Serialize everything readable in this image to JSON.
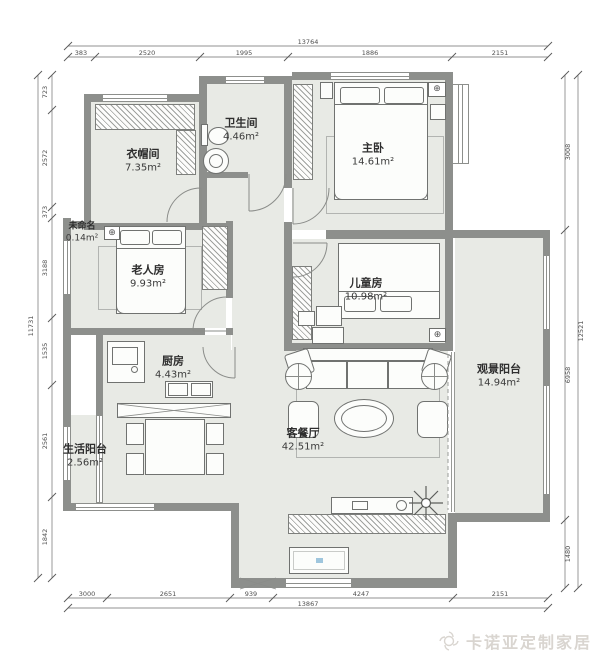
{
  "watermark": {
    "text": "卡诺亚定制家居"
  },
  "rooms": [
    {
      "id": "cloakroom",
      "name": "衣帽间",
      "area": "7.35m²"
    },
    {
      "id": "bathroom",
      "name": "卫生间",
      "area": "4.46m²"
    },
    {
      "id": "master",
      "name": "主卧",
      "area": "14.61m²"
    },
    {
      "id": "unnamed",
      "name": "未命名",
      "area": "0.14m²"
    },
    {
      "id": "elder-room",
      "name": "老人房",
      "area": "9.93m²"
    },
    {
      "id": "kids-room",
      "name": "儿童房",
      "area": "10.98m²"
    },
    {
      "id": "kitchen",
      "name": "厨房",
      "area": "4.43m²"
    },
    {
      "id": "living-dining",
      "name": "客餐厅",
      "area": "42.51m²"
    },
    {
      "id": "view-balcony",
      "name": "观景阳台",
      "area": "14.94m²"
    },
    {
      "id": "life-balcony",
      "name": "生活阳台",
      "area": "2.56m²"
    }
  ],
  "dimensions": {
    "top": {
      "total": "13764",
      "segments": [
        "383",
        "2520",
        "1995",
        "1886",
        "2151"
      ]
    },
    "bottom": {
      "total": "13867",
      "segments": [
        "3000",
        "2651",
        "939",
        "4247",
        "2151"
      ]
    },
    "left": {
      "total": "11731",
      "segments": [
        "723",
        "2572",
        "373",
        "3188",
        "1535",
        "2561",
        "1842"
      ]
    },
    "right": {
      "total": "12521",
      "segments": [
        "3008",
        "6958",
        "1480"
      ]
    }
  },
  "icons": {
    "ac": "⊕"
  },
  "colors": {
    "wall": "#8d8f8c",
    "floor": "#e8eae5",
    "furniture_outline": "#707270",
    "dimension_text": "#4f4f4f",
    "watermark": "#d9d5d0"
  }
}
